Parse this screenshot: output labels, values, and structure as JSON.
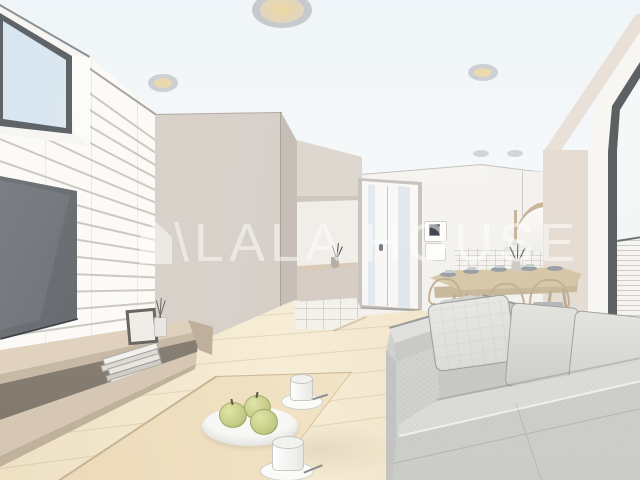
{
  "watermark": {
    "text": "\\LALA HOUSE",
    "icon": "house",
    "color": "#ffffff"
  },
  "scene": {
    "description": "3D architectural rendering of a living-dining room interior with sofa, coffee table, TV wall, entrance and kitchen",
    "colors": {
      "ceiling": "#f3f7f9",
      "brick_accent_wall": "#fbfaf7",
      "mortar": "#c1bdb4",
      "tv_screen": "#5f6368",
      "partition_wall": "#d7d0c9",
      "window_sky": "#dce9f2",
      "window_frame": "#5d6164",
      "wood_floor": "#f2e6cc",
      "wood_furniture": "#d9cbb2",
      "sofa_fabric": "#d8d9d6",
      "apples": "#c9d08c",
      "downlight_glow": "#ead2a0"
    }
  }
}
